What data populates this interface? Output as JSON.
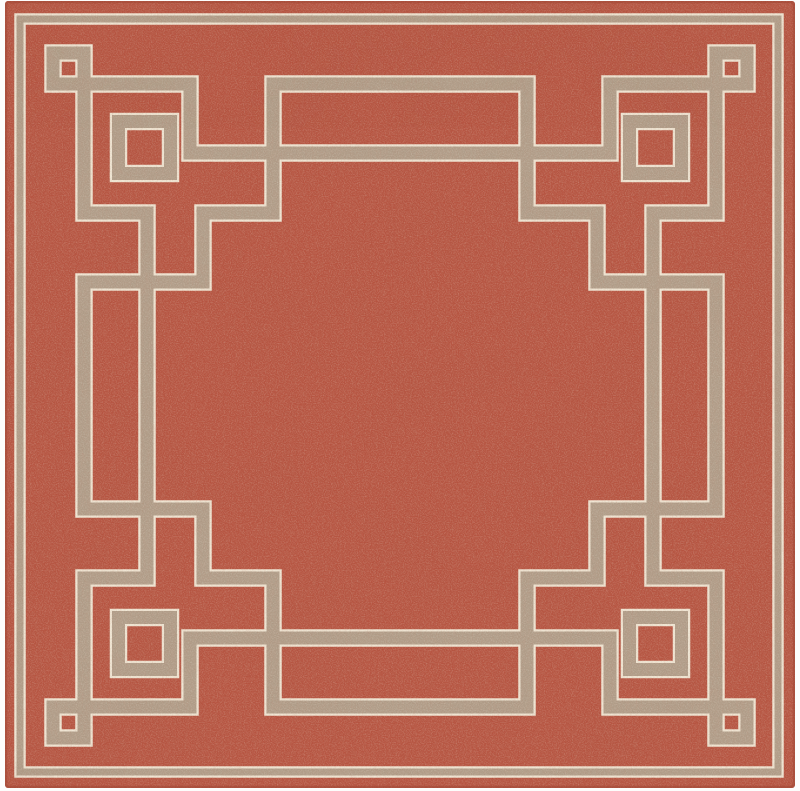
{
  "page": {
    "background_color": "#fdfdfc",
    "content_type": "product-photo",
    "subject": "square flat-weave area rug, terracotta field with taupe greek-key fret border"
  },
  "rug": {
    "width": 800,
    "height": 791,
    "colors": {
      "field_red": "#b65340",
      "field_red_edge": "#a04734",
      "line_tan": "#b09e8a",
      "line_cream": "#f0e7d5",
      "fleck_light": "#eedcc0",
      "fleck_dark": "#702b1d",
      "photo_background": "#fdfdfc"
    },
    "frame": {
      "x": 5,
      "y": 1,
      "w": 790,
      "h": 787,
      "radius": 3
    },
    "outer_border": {
      "x": 20,
      "y": 19,
      "w": 758,
      "h": 753,
      "tan_width": 7,
      "cream_width": 11.5
    },
    "pattern": {
      "tan_width": 13,
      "cream_width": 17.5,
      "squares": [
        {
          "name": "corner-small-square",
          "x": 53,
          "y": 53,
          "w": 31,
          "h": 31
        },
        {
          "name": "corner-large-square",
          "x": 118.5,
          "y": 121.5,
          "w": 52,
          "h": 52
        }
      ],
      "segments": [
        [
          84,
          84,
          190,
          84
        ],
        [
          190,
          84,
          190,
          153
        ],
        [
          190,
          153,
          400,
          153
        ],
        [
          84,
          84,
          84,
          213
        ],
        [
          84,
          213,
          147,
          213
        ],
        [
          147,
          213,
          147,
          396
        ],
        [
          273,
          84,
          400,
          84
        ],
        [
          273,
          84,
          273,
          213
        ],
        [
          203,
          213,
          273,
          213
        ],
        [
          203,
          213,
          203,
          282
        ],
        [
          84,
          282,
          203,
          282
        ],
        [
          84,
          282,
          84,
          396
        ]
      ]
    }
  }
}
